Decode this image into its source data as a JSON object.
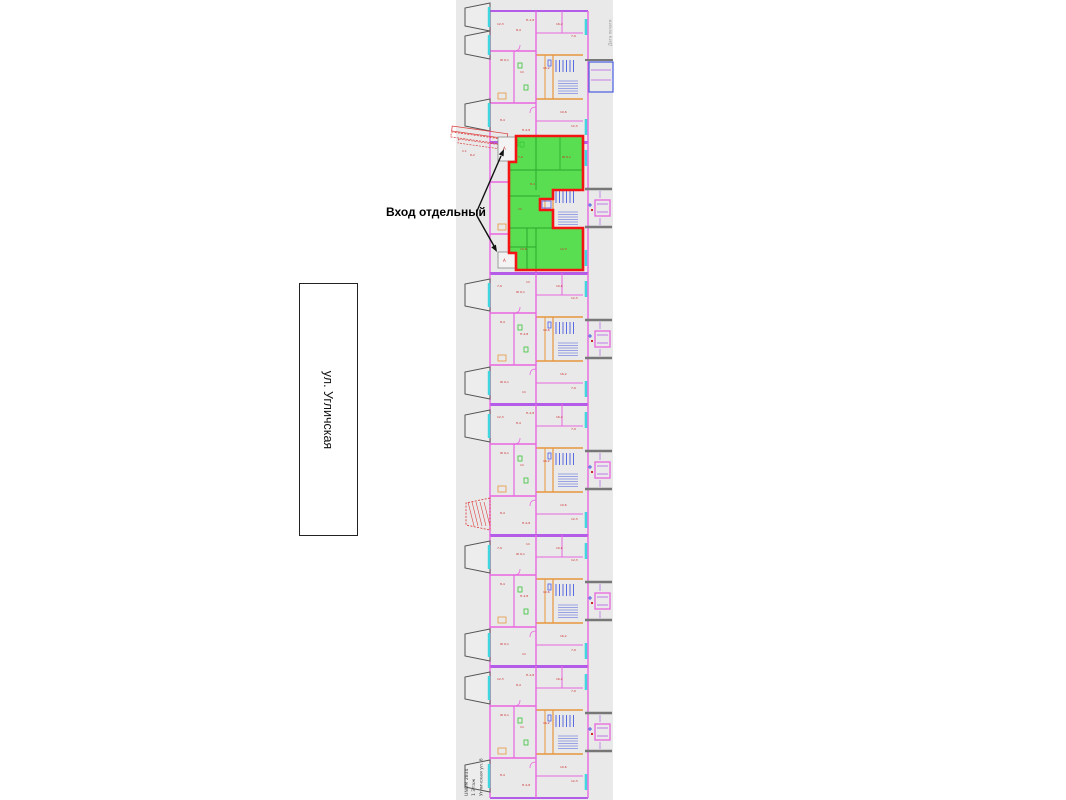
{
  "labels": {
    "separate_entrance": "Вход отдельный",
    "street": "ул. Угличская"
  },
  "title_block": {
    "unom": "UNOM 2834",
    "floor": "1 Этаж",
    "address": "Угличская ул. 6"
  },
  "print_stamp": {
    "text": "Дата печати"
  },
  "colors": {
    "sheet": "#e9e9e9",
    "wall": "#e866e0",
    "unit_wall": "#b45ce8",
    "inner_wall": "#e8963c",
    "window": "#3fd6e0",
    "stair_hatch": "#4a5ce0",
    "micro_label": "#cc2a2a",
    "fixture_green": "#35c435",
    "stoop": "#777777",
    "balcony_edge": "#555555",
    "highlight_fill": "#59de52",
    "highlight_line": "#2ca82c",
    "highlight_outline": "#f51414",
    "arrow": "#111111",
    "ramp": "#dd4444",
    "titleblock_text": "#444444",
    "stamp_text": "#999999"
  }
}
